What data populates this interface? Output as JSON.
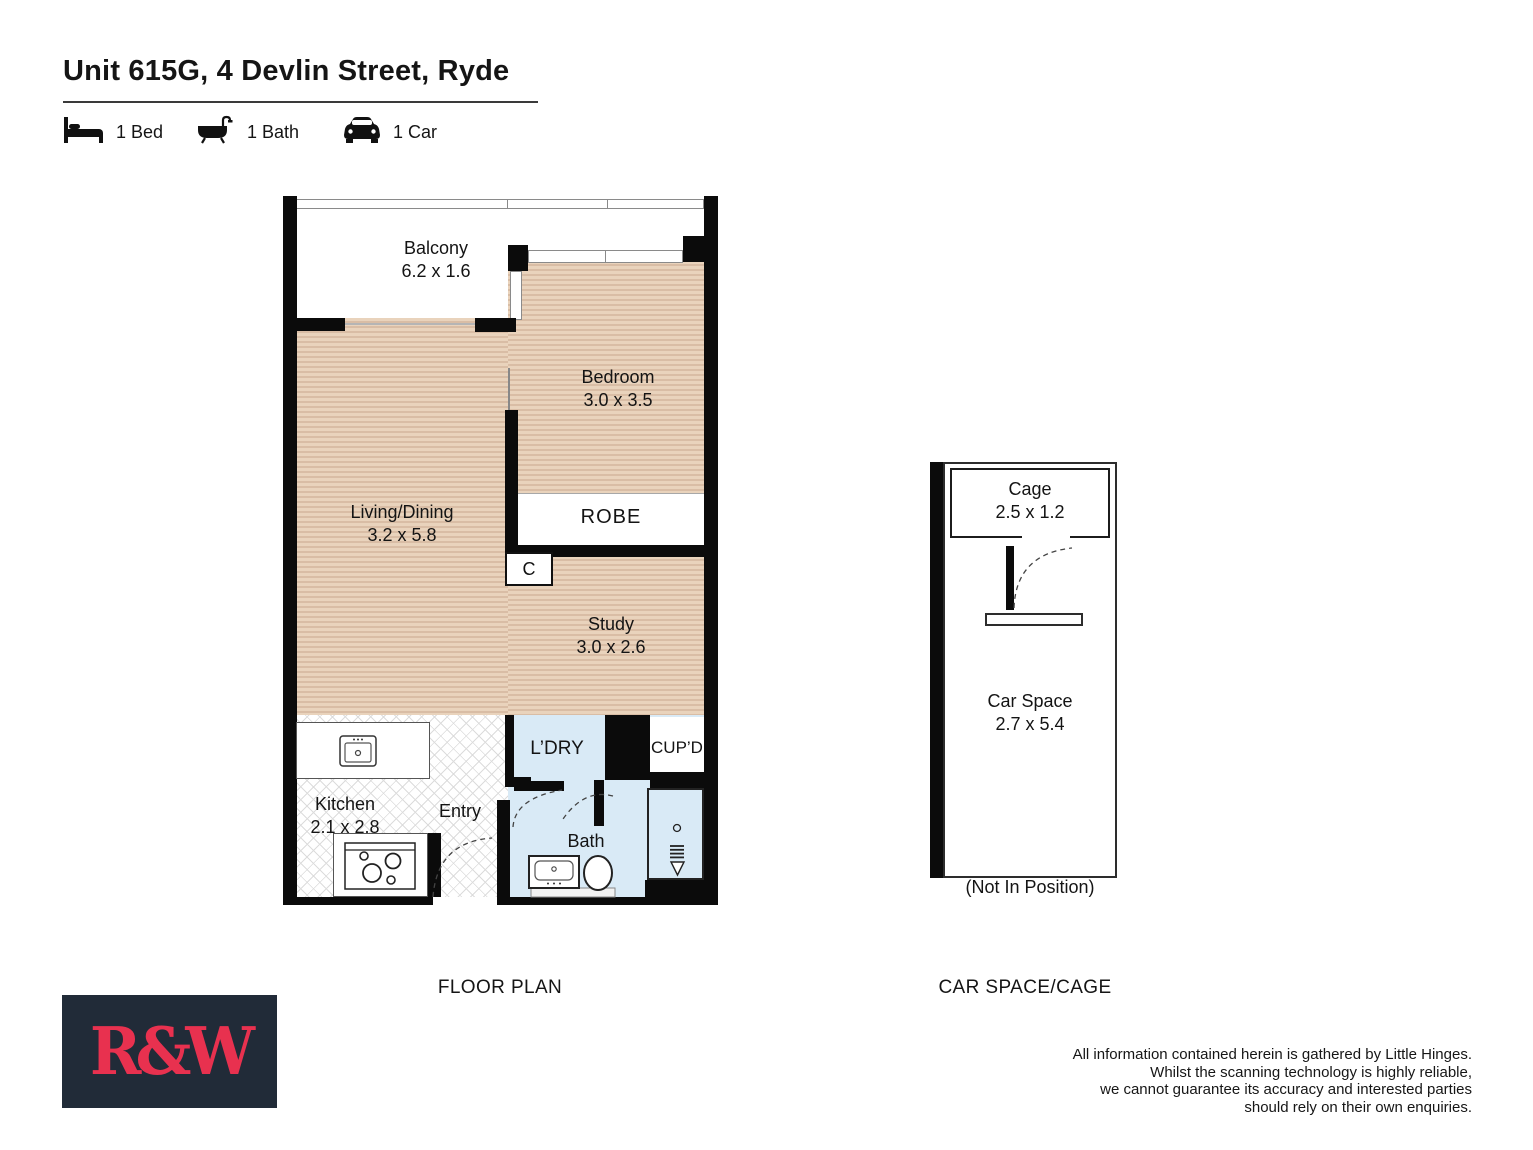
{
  "header": {
    "title": "Unit 615G, 4 Devlin Street, Ryde",
    "features": [
      {
        "icon": "bed-icon",
        "label": "1 Bed"
      },
      {
        "icon": "bath-icon",
        "label": "1 Bath"
      },
      {
        "icon": "car-icon",
        "label": "1 Car"
      }
    ]
  },
  "floor_plan": {
    "section_label": "FLOOR PLAN",
    "rooms": {
      "balcony": {
        "name": "Balcony",
        "dims": "6.2 x 1.6"
      },
      "bedroom": {
        "name": "Bedroom",
        "dims": "3.0 x 3.5"
      },
      "living_dining": {
        "name": "Living/Dining",
        "dims": "3.2 x 5.8"
      },
      "robe": {
        "name": "ROBE"
      },
      "closet": {
        "name": "C"
      },
      "study": {
        "name": "Study",
        "dims": "3.0 x 2.6"
      },
      "kitchen": {
        "name": "Kitchen",
        "dims": "2.1 x 2.8"
      },
      "entry": {
        "name": "Entry"
      },
      "laundry": {
        "name": "L’DRY"
      },
      "cupboard": {
        "name": "CUP’D"
      },
      "bath": {
        "name": "Bath"
      }
    }
  },
  "car_space": {
    "section_label": "CAR SPACE/CAGE",
    "cage": {
      "name": "Cage",
      "dims": "2.5 x 1.2"
    },
    "space": {
      "name": "Car Space",
      "dims": "2.7 x 5.4"
    },
    "note": "(Not In Position)"
  },
  "branding": {
    "logo_text": "R&W",
    "logo_bg": "#212b38",
    "logo_color": "#e8314f"
  },
  "colors": {
    "wall": "#0b0b0b",
    "wood_floor": "#e3cbb3",
    "wet_area": "#d9eaf6"
  },
  "disclaimer": {
    "lines": [
      "All information contained herein is gathered by Little Hinges.",
      "Whilst the scanning technology is highly reliable,",
      "we cannot guarantee its accuracy and interested parties",
      "should rely on their own enquiries."
    ]
  }
}
